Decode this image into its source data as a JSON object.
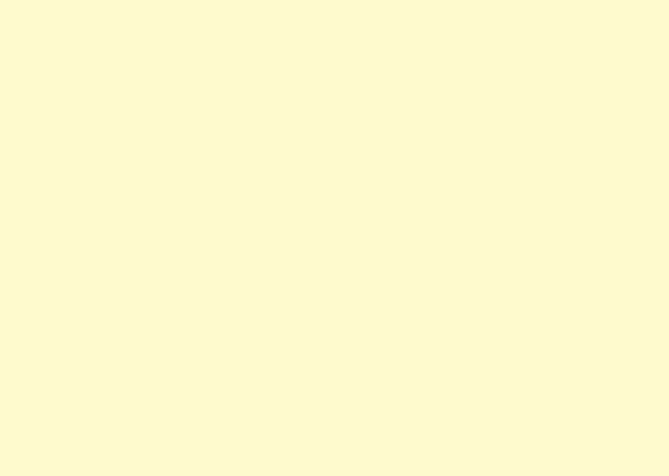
{
  "page": {
    "description": "blank solid-color screen with no visible text or controls",
    "background_color": "#FFFACD",
    "background_style": "background-color:#FFFACD",
    "width_px": 669,
    "height_px": 476
  }
}
